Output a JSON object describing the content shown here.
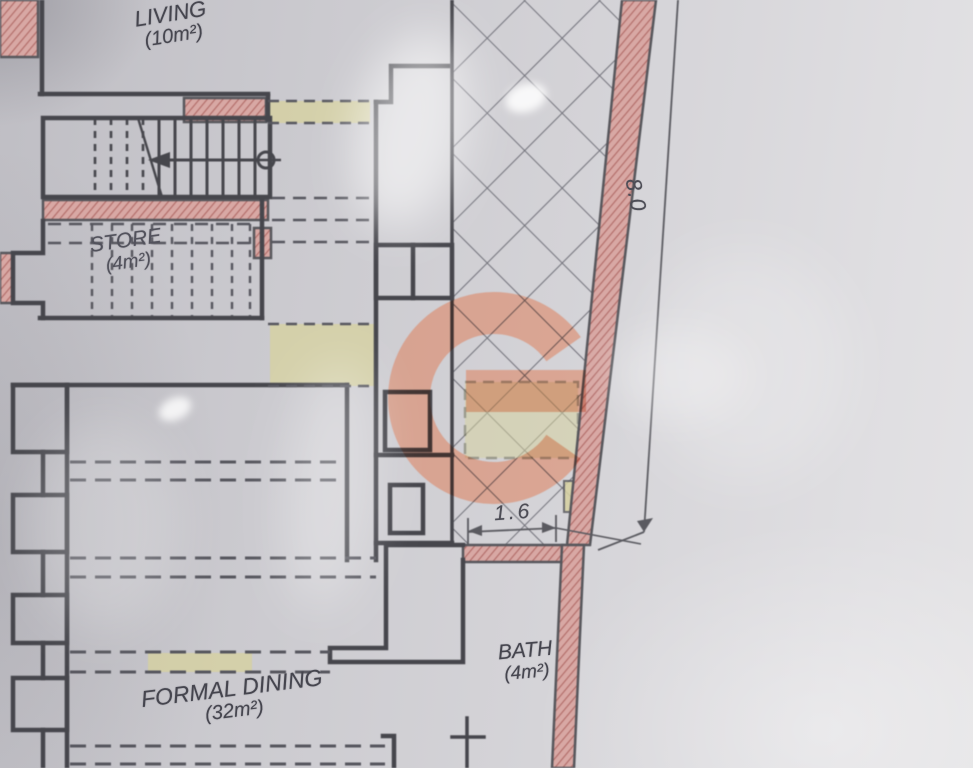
{
  "document": {
    "kind": "architectural floor plan photo"
  },
  "plan": {
    "rooms": [
      {
        "name": "LIVING",
        "area": "(10m²)"
      },
      {
        "name": "STORE",
        "area": "(4m²)"
      },
      {
        "name": "FORMAL DINING",
        "area": "(32m²)"
      },
      {
        "name": "BATH",
        "area": "(4m²)"
      }
    ],
    "dimensions": [
      {
        "value": "8.0"
      },
      {
        "value": "1.6"
      }
    ],
    "watermark": {
      "letter": "G",
      "color": "#df7850"
    },
    "colors": {
      "paper": "#cfced2",
      "wall_line": "#46464c",
      "brick_fill": "#d8a8a4",
      "brick_stroke": "#b06a66",
      "highlight": "#d6d1a0",
      "hatch_line": "#71717a"
    }
  }
}
